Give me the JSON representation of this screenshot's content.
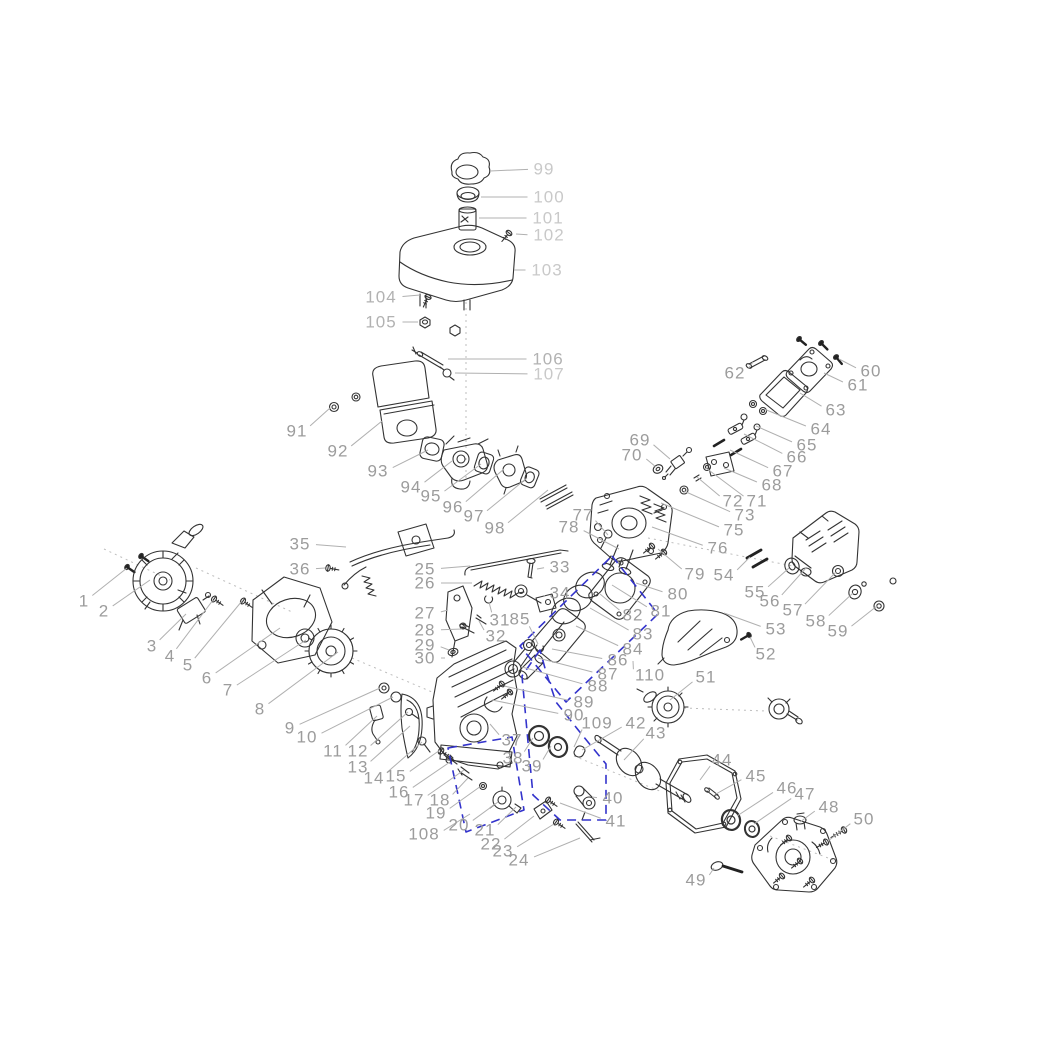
{
  "diagram": {
    "title": "engine-exploded-parts-diagram",
    "background": "#ffffff",
    "label_color": "#9c9c9c",
    "label_color_light": "#c9c9c9",
    "label_color_medium": "#b2b2b2",
    "leader_color": "#b0b0b0",
    "part_color": "#333333",
    "highlight_color": "#3333cc",
    "guide_color": "#bdbdbd",
    "font_size": 17,
    "light_labels": [
      "99",
      "100",
      "101",
      "102",
      "103",
      "107"
    ],
    "medium_labels": [
      "104",
      "105",
      "106"
    ],
    "labels": [
      {
        "t": "1",
        "x": 84,
        "y": 601,
        "ex": 127,
        "ey": 568
      },
      {
        "t": "2",
        "x": 104,
        "y": 611,
        "ex": 150,
        "ey": 580
      },
      {
        "t": "3",
        "x": 152,
        "y": 646,
        "ex": 186,
        "ey": 614
      },
      {
        "t": "4",
        "x": 170,
        "y": 656,
        "ex": 213,
        "ey": 600
      },
      {
        "t": "5",
        "x": 188,
        "y": 665,
        "ex": 242,
        "ey": 601
      },
      {
        "t": "6",
        "x": 207,
        "y": 678,
        "ex": 280,
        "ey": 628
      },
      {
        "t": "7",
        "x": 228,
        "y": 690,
        "ex": 306,
        "ey": 640
      },
      {
        "t": "8",
        "x": 260,
        "y": 709,
        "ex": 338,
        "ey": 652
      },
      {
        "t": "9",
        "x": 290,
        "y": 728,
        "ex": 380,
        "ey": 688
      },
      {
        "t": "10",
        "x": 307,
        "y": 737,
        "ex": 393,
        "ey": 697
      },
      {
        "t": "11",
        "x": 333,
        "y": 751,
        "ex": 377,
        "ey": 716
      },
      {
        "t": "12",
        "x": 358,
        "y": 751,
        "ex": 408,
        "ey": 712
      },
      {
        "t": "13",
        "x": 358,
        "y": 767,
        "ex": 410,
        "ey": 726
      },
      {
        "t": "14",
        "x": 374,
        "y": 778,
        "ex": 422,
        "ey": 742
      },
      {
        "t": "15",
        "x": 396,
        "y": 776,
        "ex": 440,
        "ey": 750
      },
      {
        "t": "16",
        "x": 399,
        "y": 792,
        "ex": 450,
        "ey": 762
      },
      {
        "t": "17",
        "x": 414,
        "y": 800,
        "ex": 464,
        "ey": 770
      },
      {
        "t": "18",
        "x": 440,
        "y": 800,
        "ex": 468,
        "ey": 778
      },
      {
        "t": "19",
        "x": 436,
        "y": 813,
        "ex": 481,
        "ey": 786
      },
      {
        "t": "20",
        "x": 459,
        "y": 825,
        "ex": 498,
        "ey": 802
      },
      {
        "t": "21",
        "x": 485,
        "y": 830,
        "ex": 516,
        "ey": 807
      },
      {
        "t": "22",
        "x": 491,
        "y": 844,
        "ex": 534,
        "ey": 816
      },
      {
        "t": "23",
        "x": 503,
        "y": 851,
        "ex": 554,
        "ey": 824
      },
      {
        "t": "24",
        "x": 519,
        "y": 860,
        "ex": 580,
        "ey": 838
      },
      {
        "t": "25",
        "x": 425,
        "y": 569,
        "ex": 470,
        "ey": 566
      },
      {
        "t": "26",
        "x": 425,
        "y": 583,
        "ex": 472,
        "ey": 583
      },
      {
        "t": "27",
        "x": 425,
        "y": 613,
        "ex": 448,
        "ey": 610
      },
      {
        "t": "28",
        "x": 425,
        "y": 630,
        "ex": 462,
        "ey": 629
      },
      {
        "t": "29",
        "x": 425,
        "y": 645,
        "ex": 449,
        "ey": 650
      },
      {
        "t": "30",
        "x": 425,
        "y": 658,
        "ex": 445,
        "ey": 658
      },
      {
        "t": "31",
        "x": 500,
        "y": 620,
        "ex": 489,
        "ey": 602
      },
      {
        "t": "32",
        "x": 496,
        "y": 636,
        "ex": 479,
        "ey": 621
      },
      {
        "t": "33",
        "x": 560,
        "y": 567,
        "ex": 537,
        "ey": 569
      },
      {
        "t": "34",
        "x": 560,
        "y": 593,
        "ex": 544,
        "ey": 597
      },
      {
        "t": "35",
        "x": 300,
        "y": 544,
        "ex": 346,
        "ey": 547
      },
      {
        "t": "36",
        "x": 300,
        "y": 569,
        "ex": 325,
        "ey": 568
      },
      {
        "t": "37",
        "x": 512,
        "y": 740,
        "ex": 490,
        "ey": 724
      },
      {
        "t": "38",
        "x": 513,
        "y": 758,
        "ex": 533,
        "ey": 738
      },
      {
        "t": "39",
        "x": 532,
        "y": 766,
        "ex": 551,
        "ey": 746
      },
      {
        "t": "40",
        "x": 613,
        "y": 798,
        "ex": 592,
        "ey": 797
      },
      {
        "t": "41",
        "x": 616,
        "y": 821,
        "ex": 560,
        "ey": 803
      },
      {
        "t": "42",
        "x": 636,
        "y": 723,
        "ex": 582,
        "ey": 750
      },
      {
        "t": "43",
        "x": 656,
        "y": 733,
        "ex": 624,
        "ey": 760
      },
      {
        "t": "44",
        "x": 722,
        "y": 760,
        "ex": 700,
        "ey": 780
      },
      {
        "t": "45",
        "x": 756,
        "y": 776,
        "ex": 716,
        "ey": 794
      },
      {
        "t": "46",
        "x": 787,
        "y": 788,
        "ex": 737,
        "ey": 816
      },
      {
        "t": "47",
        "x": 805,
        "y": 794,
        "ex": 754,
        "ey": 824
      },
      {
        "t": "48",
        "x": 829,
        "y": 807,
        "ex": 800,
        "ey": 822
      },
      {
        "t": "49",
        "x": 696,
        "y": 880,
        "ex": 714,
        "ey": 868
      },
      {
        "t": "50",
        "x": 864,
        "y": 819,
        "ex": 828,
        "ey": 841
      },
      {
        "t": "51",
        "x": 706,
        "y": 677,
        "ex": 670,
        "ey": 700
      },
      {
        "t": "52",
        "x": 766,
        "y": 654,
        "ex": 750,
        "ey": 637
      },
      {
        "t": "53",
        "x": 776,
        "y": 629,
        "ex": 724,
        "ey": 613
      },
      {
        "t": "54",
        "x": 724,
        "y": 575,
        "ex": 750,
        "ey": 557
      },
      {
        "t": "55",
        "x": 755,
        "y": 592,
        "ex": 789,
        "ey": 568
      },
      {
        "t": "56",
        "x": 770,
        "y": 601,
        "ex": 806,
        "ey": 568
      },
      {
        "t": "57",
        "x": 793,
        "y": 610,
        "ex": 836,
        "ey": 572
      },
      {
        "t": "58",
        "x": 816,
        "y": 621,
        "ex": 853,
        "ey": 593
      },
      {
        "t": "59",
        "x": 838,
        "y": 631,
        "ex": 877,
        "ey": 606
      },
      {
        "t": "60",
        "x": 871,
        "y": 371,
        "ex": 839,
        "ey": 359
      },
      {
        "t": "61",
        "x": 858,
        "y": 385,
        "ex": 824,
        "ey": 373
      },
      {
        "t": "62",
        "x": 735,
        "y": 373,
        "ex": 753,
        "ey": 362
      },
      {
        "t": "63",
        "x": 836,
        "y": 410,
        "ex": 800,
        "ey": 393
      },
      {
        "t": "64",
        "x": 821,
        "y": 429,
        "ex": 764,
        "ey": 409
      },
      {
        "t": "65",
        "x": 807,
        "y": 445,
        "ex": 756,
        "ey": 426
      },
      {
        "t": "66",
        "x": 797,
        "y": 457,
        "ex": 744,
        "ey": 434
      },
      {
        "t": "67",
        "x": 783,
        "y": 471,
        "ex": 730,
        "ey": 450
      },
      {
        "t": "68",
        "x": 772,
        "y": 485,
        "ex": 724,
        "ey": 468
      },
      {
        "t": "69",
        "x": 640,
        "y": 440,
        "ex": 670,
        "ey": 459
      },
      {
        "t": "70",
        "x": 632,
        "y": 455,
        "ex": 656,
        "ey": 467
      },
      {
        "t": "71",
        "x": 757,
        "y": 501,
        "ex": 706,
        "ey": 468
      },
      {
        "t": "72",
        "x": 733,
        "y": 501,
        "ex": 697,
        "ey": 477
      },
      {
        "t": "73",
        "x": 745,
        "y": 515,
        "ex": 684,
        "ey": 491
      },
      {
        "t": "75",
        "x": 734,
        "y": 530,
        "ex": 661,
        "ey": 503
      },
      {
        "t": "76",
        "x": 718,
        "y": 548,
        "ex": 652,
        "ey": 527
      },
      {
        "t": "77",
        "x": 583,
        "y": 515,
        "ex": 608,
        "ey": 535
      },
      {
        "t": "78",
        "x": 569,
        "y": 527,
        "ex": 619,
        "ey": 549
      },
      {
        "t": "79",
        "x": 695,
        "y": 574,
        "ex": 658,
        "ey": 549
      },
      {
        "t": "80",
        "x": 678,
        "y": 594,
        "ex": 636,
        "ey": 583
      },
      {
        "t": "81",
        "x": 661,
        "y": 611,
        "ex": 612,
        "ey": 585
      },
      {
        "t": "82",
        "x": 633,
        "y": 615,
        "ex": 600,
        "ey": 594
      },
      {
        "t": "83",
        "x": 643,
        "y": 634,
        "ex": 590,
        "ey": 608
      },
      {
        "t": "84",
        "x": 633,
        "y": 649,
        "ex": 576,
        "ey": 626
      },
      {
        "t": "85",
        "x": 520,
        "y": 619,
        "ex": 538,
        "ey": 644
      },
      {
        "t": "86",
        "x": 618,
        "y": 660,
        "ex": 552,
        "ey": 649
      },
      {
        "t": "87",
        "x": 608,
        "y": 674,
        "ex": 538,
        "ey": 658
      },
      {
        "t": "88",
        "x": 598,
        "y": 686,
        "ex": 522,
        "ey": 667
      },
      {
        "t": "89",
        "x": 584,
        "y": 702,
        "ex": 504,
        "ey": 686
      },
      {
        "t": "90",
        "x": 574,
        "y": 715,
        "ex": 492,
        "ey": 700
      },
      {
        "t": "91",
        "x": 297,
        "y": 431,
        "ex": 330,
        "ey": 408
      },
      {
        "t": "92",
        "x": 338,
        "y": 451,
        "ex": 382,
        "ey": 421
      },
      {
        "t": "93",
        "x": 378,
        "y": 471,
        "ex": 428,
        "ey": 450
      },
      {
        "t": "94",
        "x": 411,
        "y": 487,
        "ex": 452,
        "ey": 461
      },
      {
        "t": "95",
        "x": 431,
        "y": 496,
        "ex": 481,
        "ey": 464
      },
      {
        "t": "96",
        "x": 453,
        "y": 507,
        "ex": 504,
        "ey": 469
      },
      {
        "t": "97",
        "x": 474,
        "y": 516,
        "ex": 527,
        "ey": 478
      },
      {
        "t": "98",
        "x": 495,
        "y": 528,
        "ex": 548,
        "ey": 490
      },
      {
        "t": "99",
        "x": 544,
        "y": 169,
        "ex": 490,
        "ey": 171
      },
      {
        "t": "100",
        "x": 549,
        "y": 197,
        "ex": 481,
        "ey": 197
      },
      {
        "t": "101",
        "x": 548,
        "y": 218,
        "ex": 479,
        "ey": 218
      },
      {
        "t": "102",
        "x": 549,
        "y": 235,
        "ex": 516,
        "ey": 234
      },
      {
        "t": "103",
        "x": 547,
        "y": 270,
        "ex": 514,
        "ey": 270
      },
      {
        "t": "104",
        "x": 381,
        "y": 297,
        "ex": 420,
        "ey": 295
      },
      {
        "t": "105",
        "x": 381,
        "y": 322,
        "ex": 418,
        "ey": 322
      },
      {
        "t": "106",
        "x": 548,
        "y": 359,
        "ex": 448,
        "ey": 359
      },
      {
        "t": "107",
        "x": 549,
        "y": 374,
        "ex": 455,
        "ey": 373
      },
      {
        "t": "108",
        "x": 424,
        "y": 834,
        "ex": 470,
        "ey": 814
      },
      {
        "t": "109",
        "x": 597,
        "y": 723,
        "ex": 574,
        "ey": 747
      },
      {
        "t": "110",
        "x": 650,
        "y": 675,
        "ex": 633,
        "ey": 661
      }
    ],
    "dashed_groups": [
      {
        "name": "piston-assembly-group",
        "points": [
          [
            612,
            556
          ],
          [
            658,
            614
          ],
          [
            566,
            702
          ],
          [
            520,
            646
          ]
        ],
        "closed": true
      },
      {
        "name": "oil-slinger-group",
        "points": [
          [
            448,
            748
          ],
          [
            512,
            737
          ],
          [
            524,
            810
          ],
          [
            466,
            832
          ]
        ],
        "closed": true
      },
      {
        "name": "crankshaft-assembly-group",
        "points": [
          [
            540,
            650
          ],
          [
            522,
            676
          ],
          [
            528,
            742
          ],
          [
            533,
            795
          ],
          [
            560,
            820
          ],
          [
            606,
            820
          ],
          [
            606,
            764
          ],
          [
            583,
            736
          ],
          [
            556,
            702
          ],
          [
            546,
            672
          ]
        ],
        "closed": true
      }
    ],
    "dotted_guides": [
      [
        466,
        302,
        466,
        478
      ],
      [
        104,
        549,
        170,
        580
      ],
      [
        196,
        568,
        292,
        612
      ],
      [
        352,
        658,
        432,
        692
      ],
      [
        648,
        538,
        793,
        566
      ],
      [
        684,
        708,
        766,
        711
      ],
      [
        574,
        756,
        662,
        792
      ],
      [
        770,
        836,
        836,
        861
      ]
    ]
  }
}
